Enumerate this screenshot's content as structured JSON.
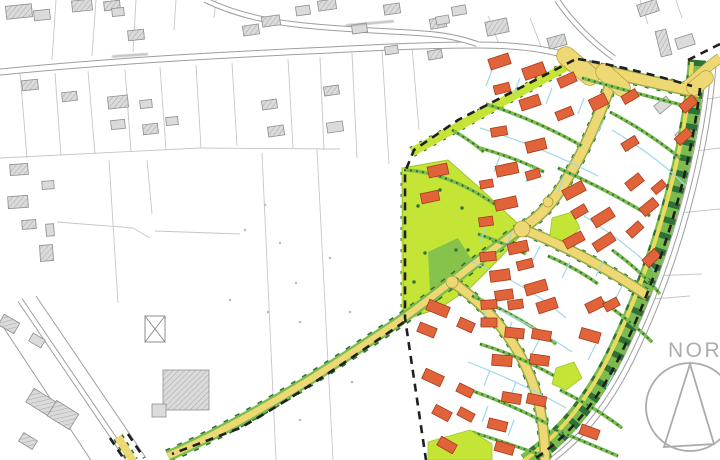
{
  "labels": {
    "north": "NORD"
  },
  "palette": {
    "parcel": "#C6C6C6",
    "roadline": "#9E9E9E",
    "grayfill": "#DBDBDB",
    "graystroke": "#8E8E8E",
    "hatchline": "#ABABAB",
    "lime": "#C4E436",
    "limestroke": "#9FC52F",
    "med": "#7CBC4F",
    "dark": "#2F7038",
    "yellow": "#EDD873",
    "yellowline": "#B29C40",
    "house": "#E0633A",
    "housestroke": "#A83A1C",
    "cyan": "#9ED8E9",
    "boundary": "#1F1F1F",
    "compass": "#ABABAB",
    "dot": "#BDBDBD"
  },
  "compass": {
    "cx": 690,
    "cy": 407,
    "r": 44,
    "triangle": "M690,364 L664,447 L714,444 Z"
  },
  "street_label_marks": [
    {
      "x": 112,
      "y": 54,
      "w": 36,
      "rot": -4
    },
    {
      "x": 346,
      "y": 22,
      "w": 48,
      "rot": -5
    }
  ],
  "parcel_lines": [
    [
      56,
      0,
      52,
      60
    ],
    [
      96,
      0,
      92,
      56
    ],
    [
      136,
      0,
      133,
      52
    ],
    [
      176,
      0,
      174,
      30
    ],
    [
      216,
      0,
      214,
      18
    ],
    [
      20,
      72,
      27,
      158
    ],
    [
      55,
      73,
      61,
      156
    ],
    [
      88,
      71,
      95,
      154
    ],
    [
      125,
      69,
      131,
      152
    ],
    [
      160,
      67,
      166,
      150
    ],
    [
      196,
      65,
      201,
      148
    ],
    [
      232,
      63,
      237,
      146
    ],
    [
      288,
      59,
      293,
      148
    ],
    [
      320,
      57,
      324,
      150
    ],
    [
      352,
      53,
      357,
      158
    ],
    [
      382,
      50,
      389,
      164
    ],
    [
      412,
      47,
      419,
      130
    ],
    [
      0,
      158,
      200,
      148
    ],
    [
      200,
      148,
      340,
      149
    ],
    [
      109,
      160,
      118,
      303
    ],
    [
      147,
      160,
      152,
      214
    ],
    [
      57,
      222,
      133,
      228
    ],
    [
      133,
      228,
      150,
      238
    ],
    [
      155,
      231,
      240,
      234
    ],
    [
      262,
      153,
      276,
      460
    ],
    [
      317,
      149,
      333,
      460
    ],
    [
      488,
      16,
      499,
      44
    ],
    [
      530,
      18,
      544,
      54
    ],
    [
      640,
      0,
      648,
      24
    ],
    [
      676,
      0,
      682,
      18
    ],
    [
      702,
      100,
      720,
      97
    ],
    [
      688,
      152,
      720,
      148
    ],
    [
      668,
      214,
      720,
      209
    ],
    [
      648,
      276,
      702,
      274
    ],
    [
      640,
      300,
      690,
      296
    ]
  ],
  "field_dots": [
    [
      265,
      205
    ],
    [
      280,
      243
    ],
    [
      296,
      283
    ],
    [
      268,
      312
    ],
    [
      300,
      322
    ],
    [
      350,
      312
    ],
    [
      330,
      258
    ],
    [
      245,
      230
    ],
    [
      352,
      382
    ],
    [
      300,
      420
    ],
    [
      230,
      300
    ]
  ],
  "existing_roads": [
    {
      "d": "M0,72 C120,60 240,54 330,50 C400,46 445,45 478,45 C520,45 552,50 575,58",
      "w": 7,
      "style": "casing"
    },
    {
      "d": "M205,0 C232,13 262,21 300,25 C345,30 395,31 430,34 C452,36 466,40 477,44",
      "w": 6,
      "style": "casing"
    },
    {
      "d": "M557,0 C572,22 592,42 614,58",
      "w": 6,
      "style": "casing"
    },
    {
      "d": "M20,300 L130,462",
      "w": 6,
      "style": "casing"
    },
    {
      "d": "M0,322 L92,462",
      "w": 1,
      "style": "thin"
    },
    {
      "d": "M36,296 L146,458",
      "w": 1,
      "style": "thin"
    },
    {
      "d": "M709,62 C702,152 674,260 626,358 C600,410 572,440 538,464",
      "w": 6,
      "style": "casing"
    },
    {
      "d": "M716,66 C709,156 681,264 633,362 C607,414 579,444 545,468",
      "w": 1,
      "style": "thin"
    }
  ],
  "gray_buildings": [
    [
      6,
      5,
      26,
      13,
      -6,
      1
    ],
    [
      34,
      10,
      16,
      10,
      -6,
      0
    ],
    [
      72,
      0,
      20,
      11,
      -6,
      1
    ],
    [
      104,
      1,
      16,
      9,
      -6,
      1
    ],
    [
      112,
      8,
      12,
      8,
      -6,
      0
    ],
    [
      128,
      30,
      16,
      10,
      -6,
      1
    ],
    [
      243,
      25,
      16,
      10,
      -8,
      1
    ],
    [
      262,
      16,
      18,
      10,
      -8,
      1
    ],
    [
      296,
      6,
      14,
      9,
      -8,
      0
    ],
    [
      318,
      0,
      18,
      10,
      -8,
      1
    ],
    [
      352,
      24,
      15,
      9,
      -8,
      0
    ],
    [
      384,
      4,
      16,
      10,
      -8,
      1
    ],
    [
      430,
      18,
      16,
      10,
      -10,
      1
    ],
    [
      452,
      6,
      14,
      9,
      -10,
      0
    ],
    [
      486,
      20,
      22,
      14,
      -12,
      1
    ],
    [
      548,
      36,
      18,
      11,
      -15,
      1
    ],
    [
      638,
      2,
      20,
      12,
      -18,
      1
    ],
    [
      658,
      30,
      11,
      26,
      -14,
      1
    ],
    [
      676,
      36,
      18,
      11,
      -18,
      0
    ],
    [
      655,
      100,
      16,
      10,
      -40,
      0
    ],
    [
      676,
      128,
      17,
      10,
      -42,
      0
    ],
    [
      22,
      80,
      16,
      10,
      -6,
      1
    ],
    [
      62,
      92,
      15,
      9,
      -6,
      1
    ],
    [
      108,
      96,
      20,
      12,
      -6,
      1
    ],
    [
      111,
      120,
      14,
      9,
      -6,
      0
    ],
    [
      140,
      100,
      12,
      8,
      -6,
      0
    ],
    [
      143,
      124,
      15,
      10,
      -6,
      1
    ],
    [
      166,
      117,
      12,
      8,
      -6,
      0
    ],
    [
      262,
      100,
      15,
      9,
      -8,
      1
    ],
    [
      268,
      126,
      16,
      10,
      -8,
      1
    ],
    [
      324,
      86,
      15,
      9,
      -8,
      1
    ],
    [
      327,
      122,
      16,
      10,
      -8,
      0
    ],
    [
      385,
      46,
      13,
      8,
      -8,
      0
    ],
    [
      428,
      50,
      14,
      9,
      -10,
      1
    ],
    [
      436,
      16,
      13,
      8,
      -10,
      0
    ],
    [
      10,
      164,
      18,
      11,
      -4,
      1
    ],
    [
      42,
      181,
      12,
      8,
      -4,
      0
    ],
    [
      8,
      196,
      20,
      12,
      -4,
      1
    ],
    [
      22,
      220,
      14,
      9,
      -4,
      1
    ],
    [
      46,
      224,
      8,
      12,
      -4,
      0
    ],
    [
      40,
      245,
      13,
      16,
      -4,
      1
    ],
    [
      0,
      318,
      18,
      12,
      30,
      1
    ],
    [
      30,
      336,
      14,
      9,
      30,
      0
    ],
    [
      28,
      394,
      26,
      16,
      32,
      1
    ],
    [
      50,
      406,
      26,
      18,
      32,
      1
    ],
    [
      20,
      436,
      16,
      10,
      32,
      1
    ],
    [
      163,
      370,
      46,
      40,
      0,
      1
    ],
    [
      152,
      404,
      14,
      13,
      0,
      0
    ]
  ],
  "crossed_box": {
    "x": 145,
    "y": 316,
    "w": 20,
    "h": 26
  },
  "belt": {
    "band": "M697,60 C690,150 662,258 614,356 C588,408 560,438 526,462",
    "stripe": "M692,62 C685,150 657,258 609,356 C583,408 556,438 522,462"
  },
  "lime_strips": [
    {
      "d": "M412,152 L574,62",
      "w": 9
    },
    {
      "d": "M405,172 L405,318",
      "w": 7
    }
  ],
  "park": {
    "outline": "M402,168 L448,160 L482,190 L516,222 L524,232 L500,258 L470,288 L440,308 L404,320 Z",
    "inner": "M428,252 L458,238 L472,260 L456,286 L430,290 Z",
    "dots": [
      [
        425,
        253
      ],
      [
        456,
        250
      ],
      [
        468,
        250
      ],
      [
        418,
        206
      ],
      [
        440,
        190
      ],
      [
        462,
        208
      ],
      [
        486,
        222
      ],
      [
        414,
        282
      ],
      [
        436,
        300
      ],
      [
        482,
        264
      ]
    ]
  },
  "lime_pockets": [
    "M552,218 L572,212 L580,228 L566,242 L550,236 Z",
    "M428,442 L470,430 L492,444 L492,460 L428,460 Z",
    "M556,368 L574,362 L582,378 L566,390 L552,384 Z"
  ],
  "avenue": {
    "d": "M168,456 C250,420 330,368 398,322 C440,292 480,258 522,228"
  },
  "yellow_roads": [
    {
      "d": "M576,65 C620,74 658,84 700,92",
      "w": 10,
      "green": true
    },
    {
      "d": "M686,86 C698,76 708,66 720,58",
      "w": 9,
      "green": false
    },
    {
      "d": "M612,80 C600,115 582,158 556,196 C544,212 534,221 522,228",
      "w": 9,
      "green": true
    },
    {
      "d": "M525,230 C570,248 610,270 648,296",
      "w": 8,
      "green": true
    },
    {
      "d": "M452,282 C490,308 515,340 530,376 C540,400 545,430 545,460",
      "w": 8,
      "green": true
    }
  ],
  "flares": [
    {
      "d": "M566,56 L590,76",
      "w": 18
    },
    {
      "d": "M604,72 L622,88",
      "w": 16
    },
    {
      "d": "M694,88 L706,78",
      "w": 14
    }
  ],
  "junctions": [
    [
      522,
      229,
      8
    ],
    [
      548,
      202,
      5
    ],
    [
      452,
      282,
      6
    ]
  ],
  "hedges": [
    "M486,104 Q536,120 582,146",
    "M610,112 Q648,132 680,158",
    "M480,148 Q516,158 544,172",
    "M558,168 Q608,190 650,216",
    "M612,250 Q640,270 660,294",
    "M478,234 Q506,244 526,254",
    "M472,296 Q520,316 556,344",
    "M548,256 Q576,268 598,284",
    "M480,344 Q520,356 558,378",
    "M470,390 Q510,404 548,424",
    "M472,432 Q510,444 544,456",
    "M582,78 Q638,94 686,106",
    "M452,130 Q470,140 484,152",
    "M600,300 Q630,320 652,342",
    "M560,390 Q596,408 622,428",
    "M556,430 Q590,444 618,456",
    "M404,170 Q450,172 500,208"
  ],
  "cyan_arcs": [
    "M480,128 Q540,146 598,176",
    "M472,262 Q530,286 566,318",
    "M468,362 Q520,382 566,408",
    "M612,130 Q656,156 686,186",
    "M584,216 Q628,244 656,272",
    "M500,310 Q540,330 572,352"
  ],
  "cyan_lines": [
    [
      492,
      70,
      486,
      86
    ],
    [
      520,
      78,
      514,
      94
    ],
    [
      552,
      88,
      546,
      104
    ],
    [
      584,
      98,
      578,
      114
    ],
    [
      500,
      156,
      494,
      172
    ],
    [
      532,
      166,
      526,
      182
    ],
    [
      564,
      176,
      558,
      192
    ],
    [
      604,
      120,
      596,
      136
    ],
    [
      636,
      136,
      628,
      152
    ],
    [
      486,
      226,
      480,
      242
    ],
    [
      512,
      232,
      506,
      248
    ],
    [
      540,
      246,
      532,
      262
    ],
    [
      570,
      262,
      562,
      278
    ],
    [
      486,
      310,
      480,
      326
    ],
    [
      512,
      322,
      506,
      338
    ],
    [
      540,
      338,
      532,
      354
    ],
    [
      490,
      370,
      484,
      386
    ],
    [
      516,
      382,
      510,
      398
    ],
    [
      488,
      406,
      482,
      422
    ],
    [
      514,
      420,
      508,
      436
    ],
    [
      604,
      260,
      596,
      276
    ],
    [
      622,
      286,
      614,
      302
    ],
    [
      596,
      344,
      588,
      360
    ],
    [
      614,
      372,
      606,
      388
    ]
  ],
  "orange_houses": [
    [
      489,
      56,
      21,
      11,
      -18
    ],
    [
      523,
      65,
      22,
      12,
      -20
    ],
    [
      558,
      75,
      18,
      10,
      -24
    ],
    [
      494,
      84,
      16,
      9,
      -14
    ],
    [
      520,
      97,
      20,
      11,
      -18
    ],
    [
      556,
      109,
      17,
      9,
      -22
    ],
    [
      491,
      127,
      16,
      9,
      -10
    ],
    [
      526,
      140,
      20,
      11,
      -14
    ],
    [
      590,
      96,
      17,
      12,
      -26
    ],
    [
      622,
      92,
      16,
      9,
      -30
    ],
    [
      680,
      99,
      17,
      10,
      -40
    ],
    [
      675,
      132,
      17,
      9,
      -42
    ],
    [
      622,
      139,
      16,
      9,
      -32
    ],
    [
      428,
      165,
      20,
      11,
      -12
    ],
    [
      496,
      164,
      22,
      11,
      -12
    ],
    [
      526,
      170,
      14,
      9,
      -16
    ],
    [
      480,
      180,
      13,
      8,
      -10
    ],
    [
      421,
      192,
      18,
      10,
      -12
    ],
    [
      495,
      198,
      22,
      11,
      -12
    ],
    [
      479,
      217,
      14,
      9,
      -8
    ],
    [
      563,
      185,
      22,
      11,
      -28
    ],
    [
      572,
      207,
      15,
      9,
      -30
    ],
    [
      592,
      212,
      22,
      11,
      -32
    ],
    [
      564,
      235,
      20,
      10,
      -28
    ],
    [
      593,
      237,
      22,
      10,
      -33
    ],
    [
      626,
      177,
      17,
      10,
      -38
    ],
    [
      652,
      183,
      14,
      8,
      -40
    ],
    [
      640,
      202,
      18,
      10,
      -40
    ],
    [
      627,
      225,
      16,
      9,
      -42
    ],
    [
      643,
      253,
      17,
      10,
      -44
    ],
    [
      508,
      242,
      20,
      11,
      -12
    ],
    [
      480,
      252,
      16,
      9,
      -5
    ],
    [
      517,
      260,
      16,
      9,
      -14
    ],
    [
      490,
      270,
      20,
      11,
      -8
    ],
    [
      525,
      282,
      22,
      11,
      -16
    ],
    [
      495,
      290,
      18,
      10,
      -8
    ],
    [
      537,
      300,
      20,
      11,
      -18
    ],
    [
      427,
      303,
      22,
      11,
      22
    ],
    [
      418,
      325,
      18,
      10,
      22
    ],
    [
      458,
      320,
      16,
      10,
      24
    ],
    [
      423,
      372,
      20,
      11,
      25
    ],
    [
      457,
      386,
      16,
      9,
      26
    ],
    [
      433,
      408,
      18,
      10,
      28
    ],
    [
      458,
      410,
      16,
      9,
      28
    ],
    [
      438,
      440,
      18,
      10,
      30
    ],
    [
      481,
      300,
      16,
      9,
      -4
    ],
    [
      508,
      300,
      15,
      9,
      -8
    ],
    [
      586,
      300,
      18,
      10,
      -26
    ],
    [
      604,
      300,
      15,
      9,
      -28
    ],
    [
      481,
      318,
      16,
      9,
      0
    ],
    [
      505,
      328,
      19,
      10,
      6
    ],
    [
      532,
      330,
      19,
      10,
      10
    ],
    [
      580,
      330,
      20,
      11,
      16
    ],
    [
      492,
      355,
      20,
      11,
      4
    ],
    [
      530,
      355,
      19,
      10,
      8
    ],
    [
      502,
      393,
      19,
      10,
      10
    ],
    [
      527,
      395,
      19,
      10,
      12
    ],
    [
      488,
      420,
      19,
      10,
      14
    ],
    [
      495,
      443,
      19,
      10,
      16
    ],
    [
      580,
      427,
      19,
      10,
      20
    ]
  ],
  "boundary_dashes": [
    "M578,59 C620,66 658,76 692,86",
    "M688,60 L720,44",
    "M574,60 L458,120 L414,150 L405,172 L405,318 L426,460",
    "M700,88 C692,160 666,262 618,360 C592,410 564,440 530,462",
    "M404,322 C360,352 300,394 240,428 L172,454",
    "M110,438 L126,462",
    "M128,434 L144,458"
  ],
  "stub": {
    "d": "M118,437 L133,461"
  }
}
